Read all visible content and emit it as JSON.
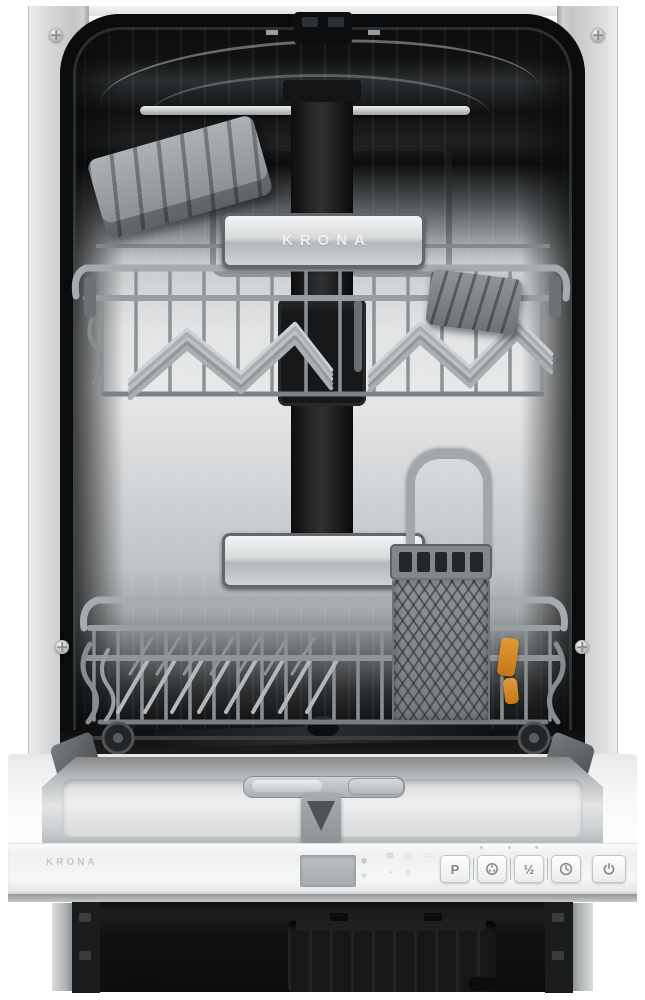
{
  "product": {
    "brand": "KRONA",
    "scene": "Built-in slim dishwasher, front view with open door showing two pull-out baskets, cutlery basket, detergent dispenser and bottom-edge control panel"
  },
  "upper_basket": {
    "handle_logo": "KRONA"
  },
  "lower_basket": {
    "accent_clip_color": "#d9882a"
  },
  "control_panel": {
    "logo": "KRONA",
    "display_value": "",
    "indicator_icons": [
      {
        "name": "salt-indicator-icon",
        "glyph": "⊠"
      },
      {
        "name": "rinse-aid-indicator-icon",
        "glyph": "▭"
      },
      {
        "name": "program-phase-indicator-icon",
        "glyph": "∷"
      },
      {
        "name": "delay-time-indicator-icon",
        "glyph": "◔"
      },
      {
        "name": "water-supply-indicator-icon",
        "glyph": "▿"
      }
    ],
    "display_side_icons": [
      {
        "name": "salt-refill-icon",
        "glyph": "✱"
      },
      {
        "name": "rinse-refill-icon",
        "glyph": "✳"
      }
    ],
    "buttons": [
      {
        "name": "program-button",
        "label": "P"
      },
      {
        "name": "extra-function-button",
        "label": ""
      },
      {
        "name": "half-load-button",
        "label": "½"
      },
      {
        "name": "delay-start-button",
        "label": ""
      },
      {
        "name": "power-button",
        "label": ""
      }
    ],
    "led_indicator_count": 3
  },
  "colors": {
    "frame_silver": "#d2d4d6",
    "tub_steel": "#dcdee0",
    "wire_gray": "#9aa0a3",
    "plastic_gray": "#8f9497",
    "accent_orange": "#d9882a",
    "base_black": "#131415",
    "panel_white": "#f5f6f7",
    "button_text": "#83878a"
  }
}
